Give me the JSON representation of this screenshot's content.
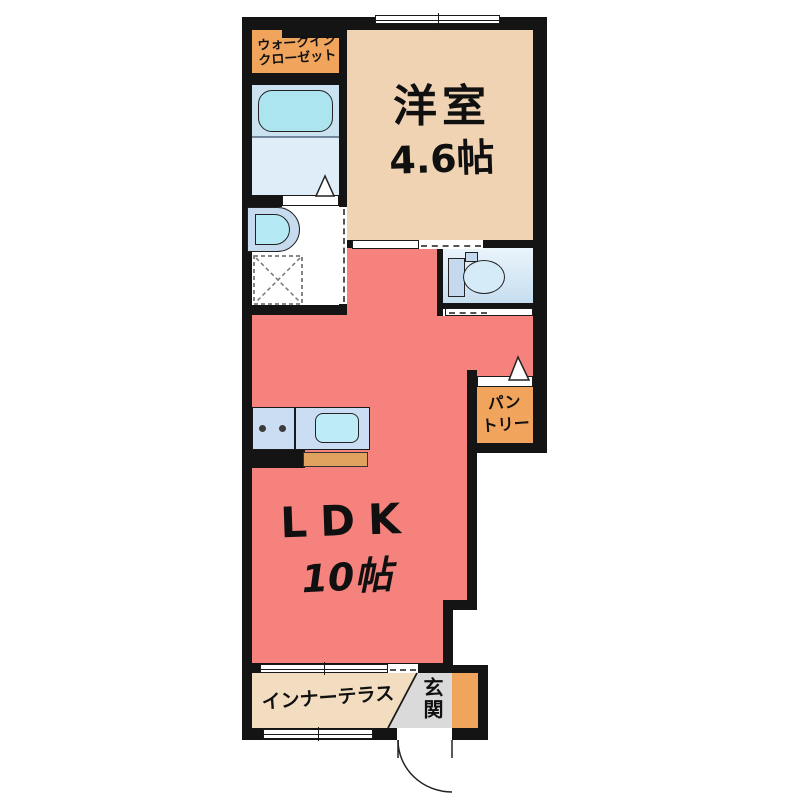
{
  "plan": {
    "walk_in_closet": {
      "line1": "ウォークイン",
      "line2": "クローゼット"
    },
    "western_room": {
      "name": "洋室",
      "size": "4.6帖"
    },
    "ldk": {
      "name": "LDK",
      "size": "10帖"
    },
    "pantry": {
      "line1": "パン",
      "line2": "トリー"
    },
    "inner_terrace": {
      "label": "インナーテラス"
    },
    "entrance": {
      "label": "玄関"
    }
  },
  "colors": {
    "wall": "#141414",
    "ldk_floor": "#F5827D",
    "western_room_floor": "#EFD3B3",
    "closet_floor": "#F1A45C",
    "pantry_floor": "#F1A45C",
    "terrace_floor": "#F3DDC1",
    "entrance_floor": "#DADADA",
    "entrance_accent_strip": "#F1A45C",
    "bathtub": "#ACE4F0",
    "bath_floor": "#CBE2F1",
    "washbasin": "#B5E9F3",
    "toilet_room": "#D9EAF7",
    "kitchen_counter": "#CADDF2",
    "kitchen_sink": "#BEECF6",
    "kitchen_cabinet": "#E2A25F"
  }
}
